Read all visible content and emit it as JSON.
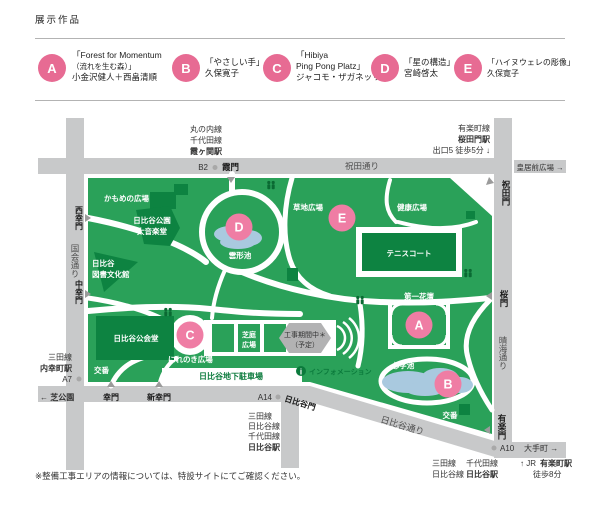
{
  "legend": {
    "heading": "展示作品",
    "items": [
      {
        "letter": "A",
        "line1": "「Forest for Momentum",
        "line2": "（流れを生む森）」",
        "line3": "小金沢健人＋西畠清順"
      },
      {
        "letter": "B",
        "line1": "「やさしい手」",
        "line2": "久保寛子",
        "line3": ""
      },
      {
        "letter": "C",
        "line1": "「Hibiya",
        "line2": "Ping Pong Platz」",
        "line3": "ジャコモ・ザガネッリ"
      },
      {
        "letter": "D",
        "line1": "「星の構造」",
        "line2": "宮崎啓太",
        "line3": ""
      },
      {
        "letter": "E",
        "line1": "「ハイヌウェレの彫像」",
        "line2": "久保寛子",
        "line3": ""
      }
    ]
  },
  "map": {
    "stations": {
      "kasumigaseki": {
        "l1": "丸の内線",
        "l2": "千代田線",
        "name": "霞ヶ関駅"
      },
      "sakuradamon": {
        "l1": "有楽町線",
        "name": "桜田門駅",
        "exit": "出口5 徒歩5分 ↓"
      },
      "uchisaiwaicho": {
        "l1": "三田線",
        "name": "内幸町駅",
        "exit": "A7"
      },
      "hibiya_south": {
        "l1": "三田線",
        "l2": "日比谷線",
        "l3": "千代田線",
        "name": "日比谷駅"
      },
      "hibiya_east": {
        "a": "三田線",
        "b": "千代田線",
        "c": "日比谷線",
        "d": "日比谷駅"
      },
      "jr_yurakucho": {
        "a": "↑ JR",
        "b": "有楽町駅",
        "c": "徒歩8分"
      }
    },
    "exits": {
      "b2": "B2",
      "a14": "A14",
      "a10": "A10"
    },
    "roads": {
      "shukuda": "祝田通り",
      "kokkai": "国会通り",
      "harumi": "晴海通り",
      "hibiya": "日比谷通り",
      "kokyomae": "皇居前広場 →",
      "otemachi": "大手町 →",
      "shibakoen": "← 芝公園"
    },
    "gates": {
      "kasumi": "霞門",
      "iwaida": "祝田門",
      "sakura": "桜門",
      "yuraku": "有楽門",
      "nishisaiwai": "西幸門",
      "nakasaiwai": "中幸門",
      "saiwai": "幸門",
      "shinsaiwai": "新幸門",
      "hibiya": "日比谷門"
    },
    "areas": {
      "kamome": "かもめの広場",
      "ongakudo1": "日比谷公園",
      "ongakudo2": "大音楽堂",
      "library1": "日比谷",
      "library2": "図書文化館",
      "kokaido": "日比谷公会堂",
      "koban1": "交番",
      "koban2": "交番",
      "kumogata": "雲形池",
      "kusachi": "草地広場",
      "kenko": "健康広場",
      "tennis": "テニスコート",
      "daiichi": "第一花壇",
      "shinji": "心字池",
      "nirenoki": "にれのき広場",
      "shibaniwa1": "芝庭",
      "shibaniwa2": "広場",
      "koji1": "工事期間中＊",
      "koji2": "（予定）",
      "parking": "日比谷地下駐車場",
      "info": "インフォメーション",
      "info_i": "i"
    },
    "markers": {
      "a": "A",
      "b": "B",
      "c": "C",
      "d": "D",
      "e": "E"
    }
  },
  "footer": {
    "note": "※整備工事エリアの情報については、特設サイトにてご確認ください。"
  },
  "colors": {
    "park_green": "#2aa159",
    "dark_green": "#0d8341",
    "road_gray": "#c8c9ca",
    "marker_pink": "#ef7da4",
    "legend_pink": "#e76b93",
    "pond_blue": "#a9c9df",
    "construction_gray": "#b2b2b3",
    "info_green": "#0b7a3c"
  }
}
